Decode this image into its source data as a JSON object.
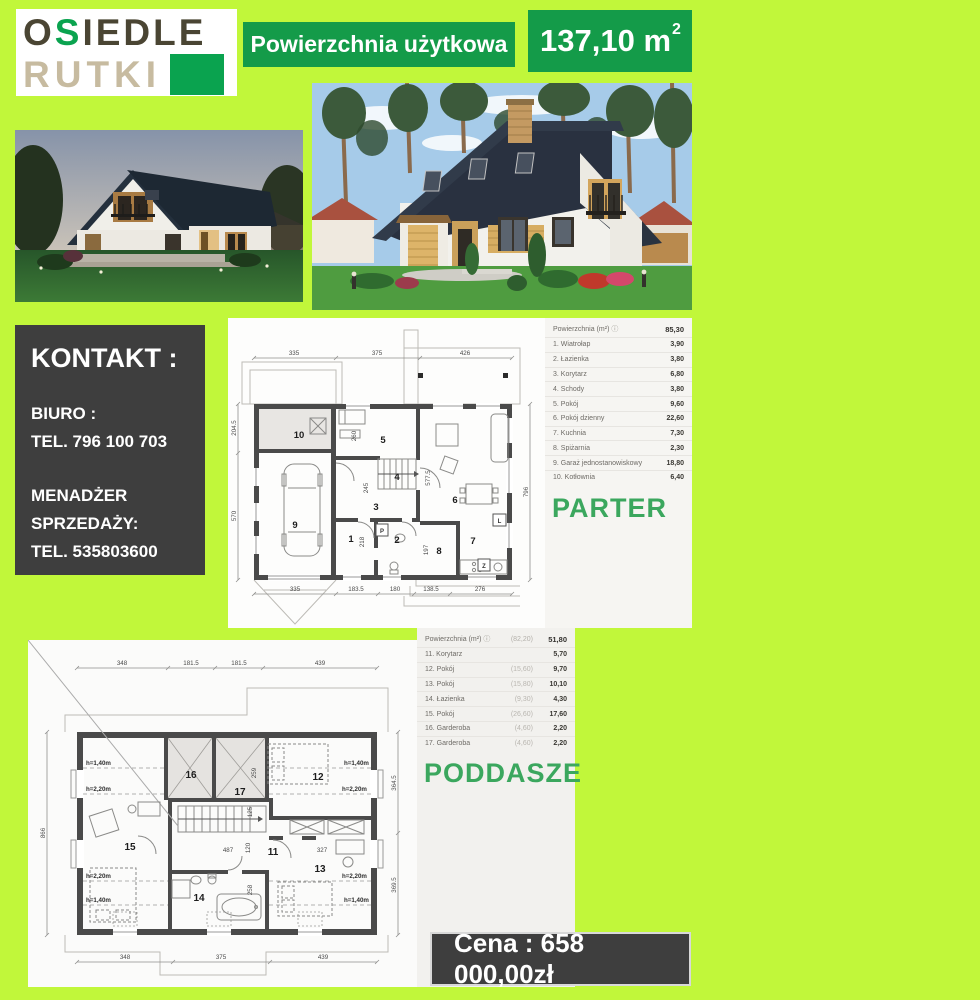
{
  "colors": {
    "background": "#c1f73a",
    "accent_green": "#149b49",
    "logo_green": "#0aa34f",
    "dark_box": "#3e3e3e",
    "title_green": "#3ba75e"
  },
  "logo": {
    "part1": "O",
    "part2": "S",
    "part3": "IEDLE",
    "line2": "RUTKI"
  },
  "header": {
    "area_label": "Powierzchnia użytkowa",
    "area_value": "137,10 m",
    "area_sup": "2"
  },
  "shared": {
    "info_icon": "ⓘ"
  },
  "contact": {
    "title": "KONTAKT :",
    "office_label": "BIURO :",
    "office_phone": "TEL. 796 100 703",
    "manager_line1": "MENADŻER",
    "manager_line2": "SPRZEDAŻY:",
    "manager_phone": "TEL. 535803600"
  },
  "price": {
    "label": "Cena : 658 000,00zł"
  },
  "parter": {
    "title": "PARTER",
    "table": {
      "header_label": "Powierzchnia (m²)",
      "header_value": "85,30",
      "rows": [
        {
          "name": "1. Wiatrołap",
          "value": "3,90"
        },
        {
          "name": "2. Łazienka",
          "value": "3,80"
        },
        {
          "name": "3. Korytarz",
          "value": "6,80"
        },
        {
          "name": "4. Schody",
          "value": "3,80"
        },
        {
          "name": "5. Pokój",
          "value": "9,60"
        },
        {
          "name": "6. Pokój dzienny",
          "value": "22,60"
        },
        {
          "name": "7. Kuchnia",
          "value": "7,30"
        },
        {
          "name": "8. Spiżarnia",
          "value": "2,30"
        },
        {
          "name": "9. Garaż jednostanowiskowy",
          "value": "18,80"
        },
        {
          "name": "10. Kotłownia",
          "value": "6,40"
        }
      ]
    },
    "plan": {
      "dims_top": [
        "335",
        "375",
        "426"
      ],
      "dims_left": [
        "204.5",
        "570"
      ],
      "dim_right": "796",
      "dims_bottom": [
        "335",
        "183.5",
        "180",
        "138.5",
        "276"
      ],
      "dims_inner": [
        "260",
        "245",
        "218",
        "197",
        "577.5"
      ],
      "rooms": [
        "1",
        "2",
        "3",
        "4",
        "5",
        "6",
        "7",
        "8",
        "9",
        "10"
      ],
      "letters": [
        "P",
        "L",
        "Z"
      ]
    }
  },
  "poddasze": {
    "title": "PODDASZE",
    "table": {
      "header_label": "Powierzchnia (m²)",
      "header_extra": "(82,20)",
      "header_value": "51,80",
      "rows": [
        {
          "name": "11. Korytarz",
          "extra": "",
          "value": "5,70"
        },
        {
          "name": "12. Pokój",
          "extra": "(15,60)",
          "value": "9,70"
        },
        {
          "name": "13. Pokój",
          "extra": "(15,80)",
          "value": "10,10"
        },
        {
          "name": "14. Łazienka",
          "extra": "(9,30)",
          "value": "4,30"
        },
        {
          "name": "15. Pokój",
          "extra": "(26,60)",
          "value": "17,60"
        },
        {
          "name": "16. Garderoba",
          "extra": "(4,60)",
          "value": "2,20"
        },
        {
          "name": "17. Garderoba",
          "extra": "(4,60)",
          "value": "2,20"
        }
      ]
    },
    "plan": {
      "dims_top": [
        "348",
        "181.5",
        "181.5",
        "439"
      ],
      "dim_left": "866",
      "dims_right": [
        "364.5",
        "369.5"
      ],
      "dims_bottom": [
        "348",
        "375",
        "439"
      ],
      "dims_inner": [
        "259",
        "125",
        "120",
        "487",
        "327",
        "258"
      ],
      "rooms": [
        "11",
        "12",
        "13",
        "14",
        "15",
        "16",
        "17"
      ],
      "h140": "h=1,40m",
      "h220": "h=2,20m"
    }
  }
}
